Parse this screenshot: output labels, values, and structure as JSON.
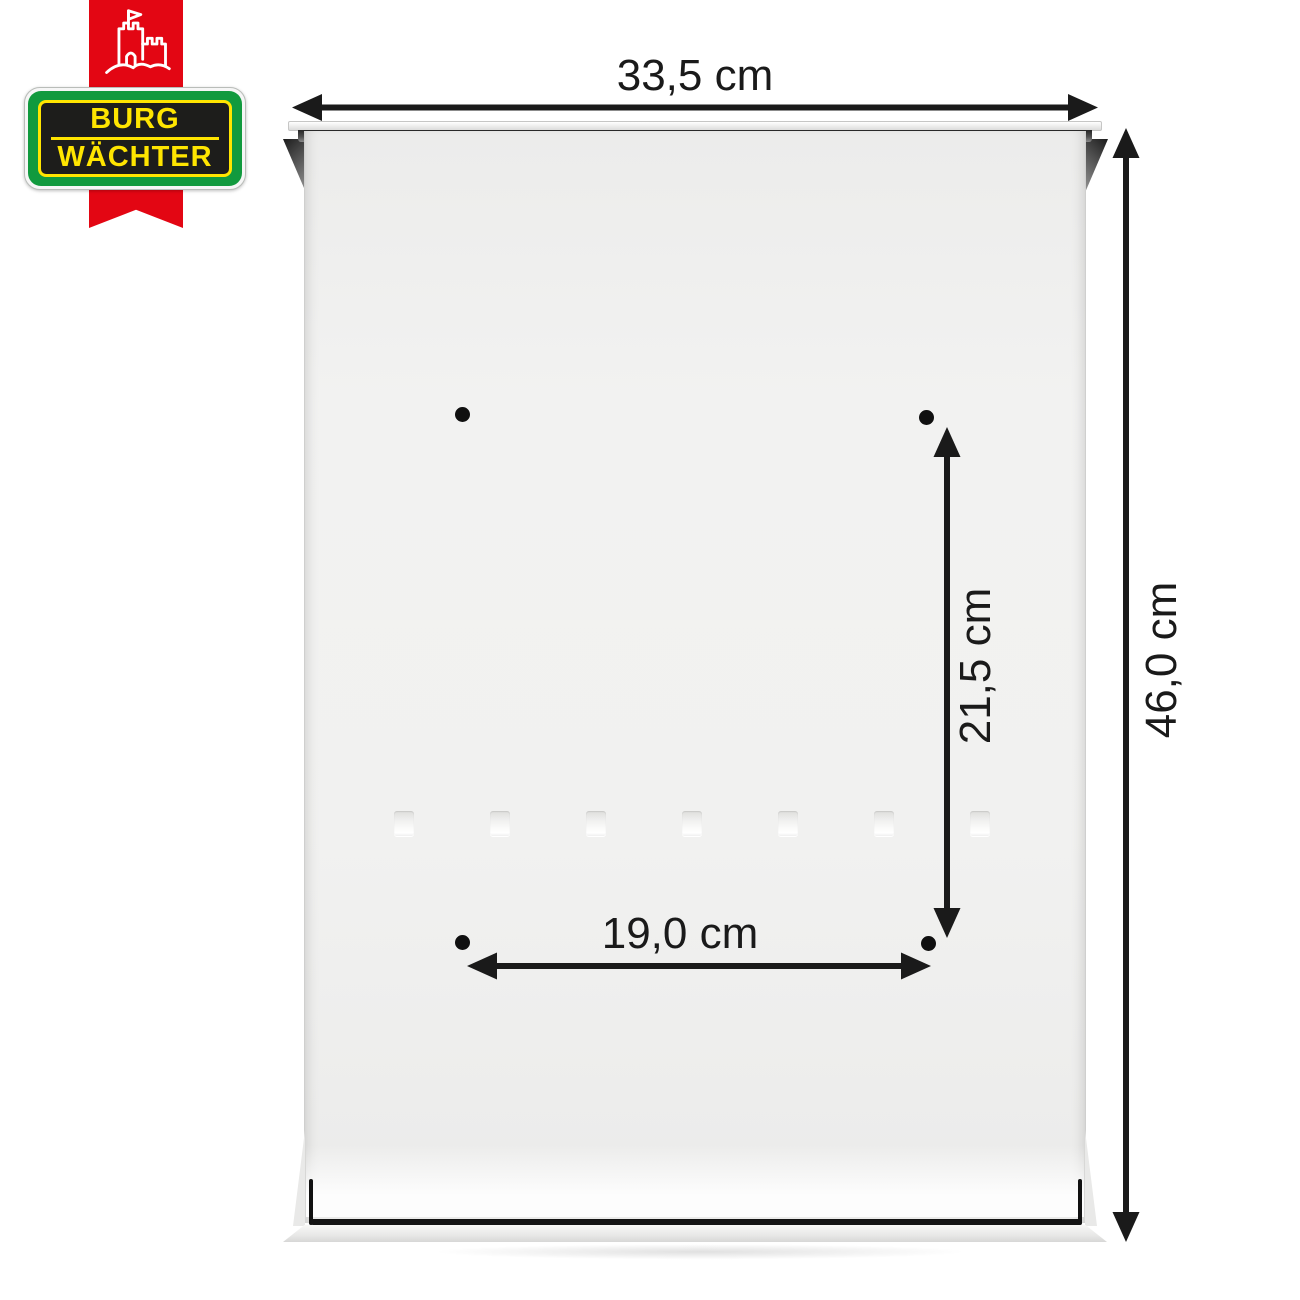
{
  "brand": {
    "line1": "BURG",
    "line2": "WÄCHTER",
    "colors": {
      "ribbon_red": "#e30613",
      "badge_green": "#119a3e",
      "badge_yellow": "#ffe500",
      "badge_black": "#1d1d1b"
    }
  },
  "dimensions": {
    "overall_width": "33,5 cm",
    "overall_height": "46,0 cm",
    "hole_spacing_vertical": "21,5 cm",
    "hole_spacing_horizontal": "19,0 cm"
  },
  "product": {
    "view": "mailbox back panel",
    "mounting_hole_count": 4,
    "embossed_slot_count": 7,
    "annotation_color": "#1a1a1a",
    "panel_color": "#f1f1f0"
  }
}
